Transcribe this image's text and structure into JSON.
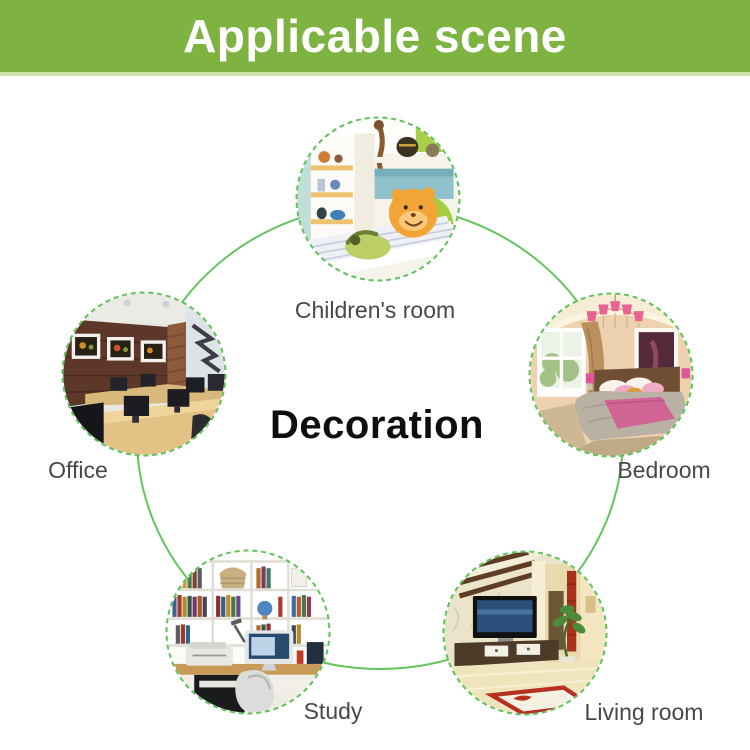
{
  "banner": {
    "title": "Applicable scene"
  },
  "center": {
    "title": "Decoration"
  },
  "scenes": [
    {
      "id": "children-room",
      "label": "Children's room"
    },
    {
      "id": "office",
      "label": "Office"
    },
    {
      "id": "bedroom",
      "label": "Bedroom"
    },
    {
      "id": "study",
      "label": "Study"
    },
    {
      "id": "living-room",
      "label": "Living room"
    }
  ],
  "colors": {
    "banner_green": "#7eb341",
    "banner_text": "#ffffff",
    "connector_green": "#64c45f",
    "ring_green": "#5fc35b",
    "label_text": "#484848",
    "center_title_text": "#0e0e0e"
  }
}
